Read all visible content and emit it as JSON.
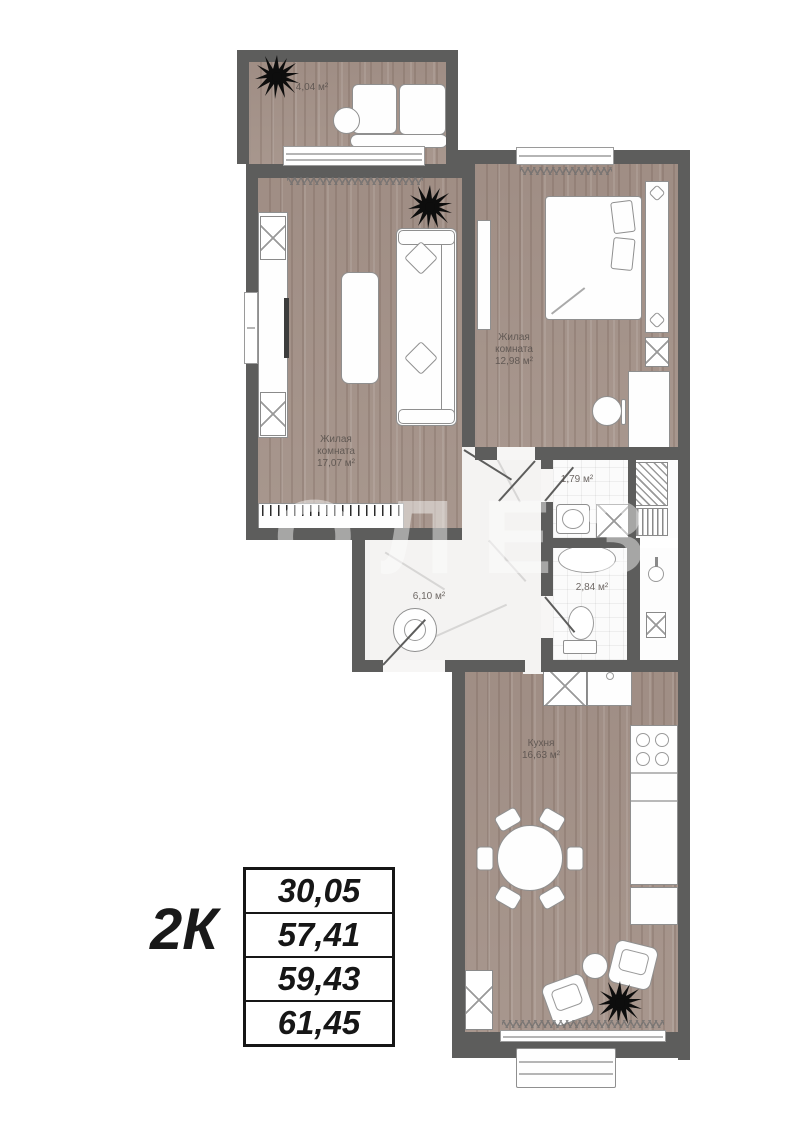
{
  "watermark": {
    "text": "ПОЛЕЗ"
  },
  "plan": {
    "rooms": {
      "balcony": {
        "area": "4,04 м²"
      },
      "living": {
        "name": "Жилая комната",
        "area": "17,07 м²"
      },
      "bedroom": {
        "name": "Жилая комната",
        "area": "12,98 м²"
      },
      "wc": {
        "area": "1,79 м²"
      },
      "bathroom": {
        "area": "2,84 м²"
      },
      "hall": {
        "area": "6,10 м²"
      },
      "kitchen": {
        "name": "Кухня",
        "area": "16,63 м²"
      }
    }
  },
  "summary": {
    "type_label": "2К",
    "areas": [
      "30,05",
      "57,41",
      "59,43",
      "61,45"
    ]
  },
  "colors": {
    "wall": "#5d5d5c",
    "wood": "#a5948b",
    "marble": "#f4f3f2",
    "table_ink": "#161616"
  }
}
